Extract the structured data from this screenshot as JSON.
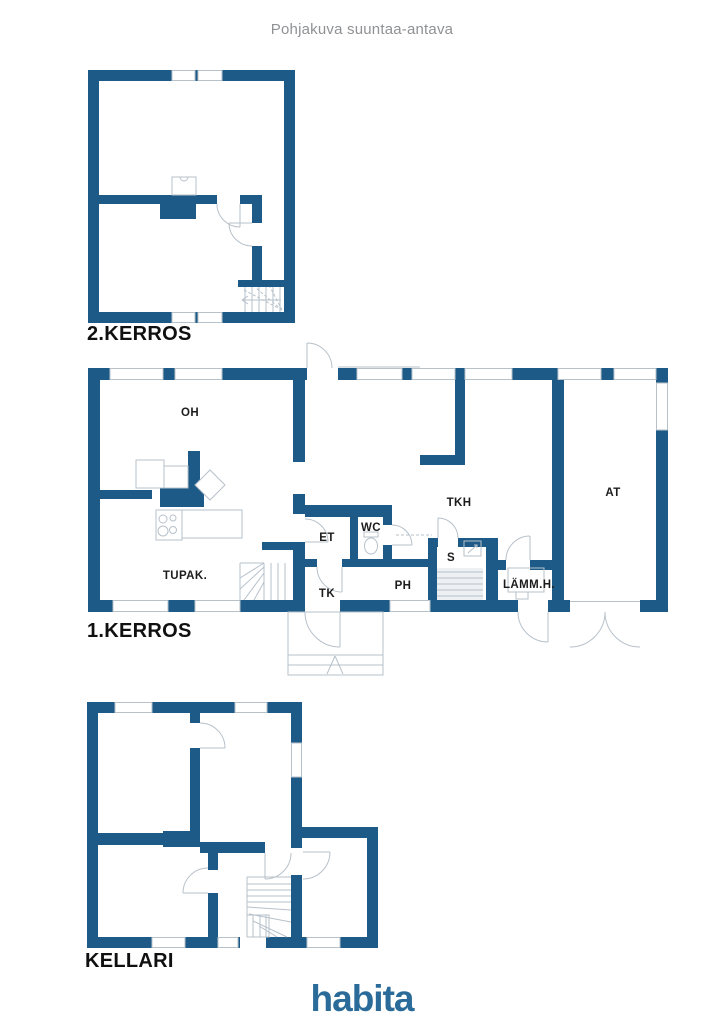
{
  "header": {
    "title": "Pohjakuva suuntaa-antava"
  },
  "floors": [
    {
      "id": "floor2",
      "label": "2.KERROS",
      "rooms": []
    },
    {
      "id": "floor1",
      "label": "1.KERROS",
      "rooms": [
        {
          "key": "oh",
          "label": "OH"
        },
        {
          "key": "tupak",
          "label": "TUPAK."
        },
        {
          "key": "et",
          "label": "ET"
        },
        {
          "key": "wc",
          "label": "WC"
        },
        {
          "key": "tk",
          "label": "TK"
        },
        {
          "key": "ph",
          "label": "PH"
        },
        {
          "key": "s",
          "label": "S"
        },
        {
          "key": "tkh",
          "label": "TKH"
        },
        {
          "key": "lammh",
          "label": "LÄMM.H."
        },
        {
          "key": "at",
          "label": "AT"
        }
      ]
    },
    {
      "id": "kellari",
      "label": "KELLARI",
      "rooms": []
    }
  ],
  "branding": {
    "logo_text": "habita"
  },
  "colors": {
    "wall": "#1e5a87",
    "fixture_line": "#b7c1ca",
    "stair_fill": "#eef1f3",
    "label": "#1c1c1c",
    "title": "#8f9194",
    "logo": "#2a6b9a"
  }
}
